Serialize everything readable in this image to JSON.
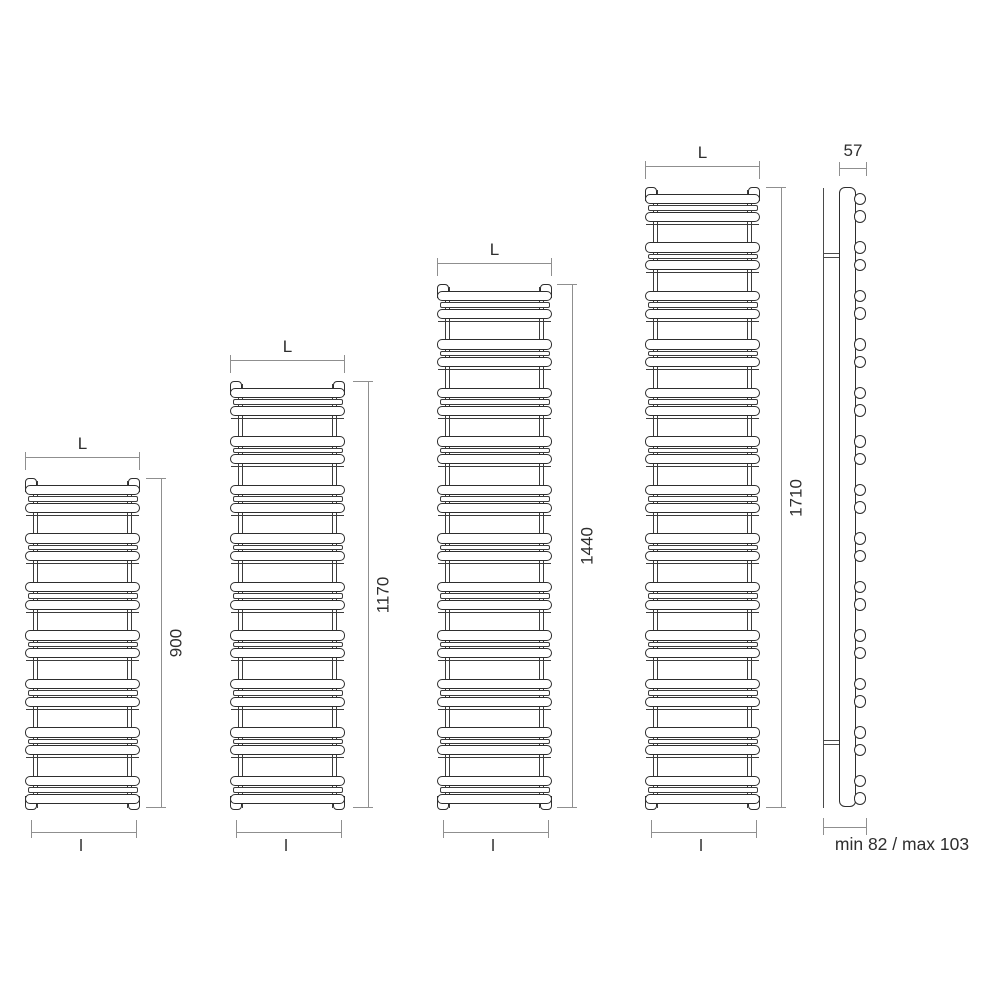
{
  "drawing_type": "heated-towel-rail-dimension-diagram",
  "labels": {
    "overall_width": "L",
    "inner_width": "l"
  },
  "front_views": [
    {
      "height_mm": "900",
      "bar_pairs": 7
    },
    {
      "height_mm": "1170",
      "bar_pairs": 9
    },
    {
      "height_mm": "1440",
      "bar_pairs": 11
    },
    {
      "height_mm": "1710",
      "bar_pairs": 13
    }
  ],
  "side_view": {
    "depth_mm": "57",
    "wall_distance": "min 82 / max 103",
    "bar_pairs": 13
  },
  "colors": {
    "outline": "#2e2e2e",
    "dim_line": "#8f8f8f",
    "text": "#2e2e2e",
    "background": "#ffffff"
  }
}
